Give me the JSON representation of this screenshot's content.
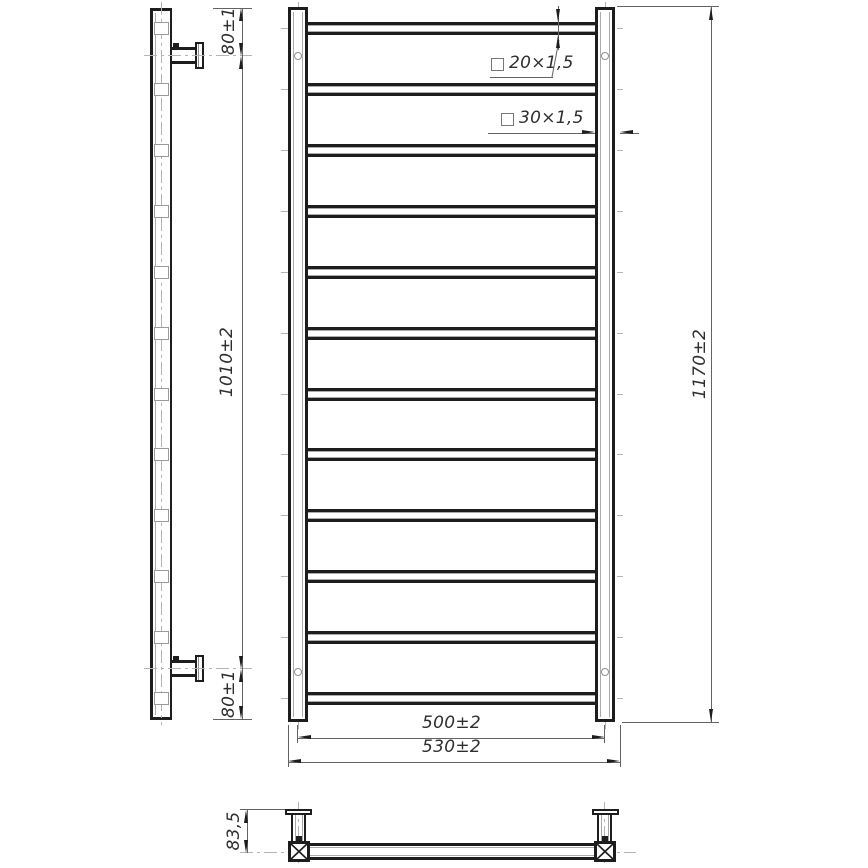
{
  "drawing_type": "technical drawing — ladder towel rail, three orthographic views",
  "views": {
    "side": {
      "rung_count": 12,
      "bracket_count": 2,
      "dim_top_offset": "80±1",
      "dim_bracket_span": "1010±2",
      "dim_bottom_offset": "80±1"
    },
    "front": {
      "rung_count": 12,
      "mounting_hole_count": 4,
      "rung_tube_label": "20×1,5",
      "post_tube_label": "30×1,5",
      "dim_overall_height": "1170±2",
      "dim_post_centers": "500±2",
      "dim_overall_width": "530±2"
    },
    "plan": {
      "bracket_count": 2,
      "dim_wall_offset": "83,5"
    }
  },
  "colors": {
    "outline": "#1d1d1d",
    "thin_line": "#a6a6a6",
    "centerline": "#b4b4b4",
    "dimension_line": "#636363",
    "text": "#2e2e2e",
    "background": "#ffffff"
  }
}
